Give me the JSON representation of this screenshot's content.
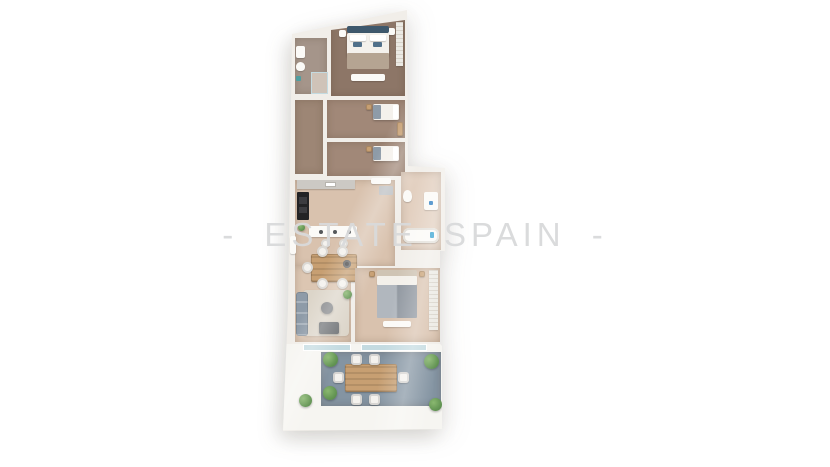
{
  "watermark": {
    "text": "- ESTATE SPAIN -"
  },
  "scene": {
    "type": "3d-floor-plan-top-view",
    "rooms": [
      "bathroom-top",
      "master-bedroom",
      "single-bedroom-a",
      "single-bedroom-b",
      "corridor",
      "kitchen",
      "dining-area",
      "main-bathroom",
      "living-room",
      "double-bedroom",
      "terrace"
    ]
  },
  "colors": {
    "wall": "#f1eee9",
    "white_fixture": "#fbfaf7",
    "floor_dark": "#8d7667",
    "floor_mid": "#9d8675",
    "floor_room": "#a18878",
    "floor_tan": "#d9c2ae",
    "floor_tan_light": "#dcc6b2",
    "bath_tile": "#a5958a",
    "bath_tile_light": "#e2cfbf",
    "terrace": "#8494a2",
    "rug": "#dcd5c9",
    "sofa": "#8e9ba8",
    "headboard": "#3e586c",
    "pillow_blue": "#51708a",
    "blanket": "#b5a492",
    "duvet": "#9ba3ac",
    "wood": "#c79f72",
    "chair": "#f4f2ee",
    "appliance_black": "#232325",
    "counter": "#ccc9c4",
    "plant": "#5f9150",
    "glass": "#c4dbe1",
    "teal_towel": "#4f9ea0",
    "watermark_color": "#d9dadb"
  }
}
